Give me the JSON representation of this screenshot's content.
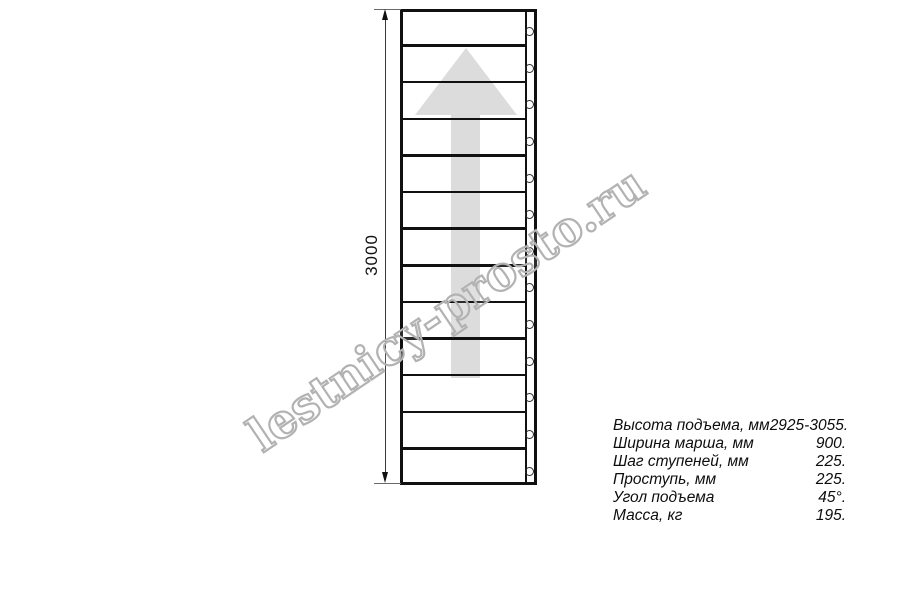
{
  "watermark": {
    "text": "lestnicy-prosto.ru",
    "color": "#b2b2b2"
  },
  "drawing": {
    "dimension_label": "3000",
    "step_rows": 13,
    "hole_count": 13,
    "line_color": "#111111",
    "arrow_color": "#dcdcdc"
  },
  "specs": {
    "rows": [
      {
        "label": "Высота подъема, мм",
        "value": "2925-3055."
      },
      {
        "label": "Ширина марша, мм",
        "value": "900."
      },
      {
        "label": "Шаг ступеней, мм",
        "value": "225."
      },
      {
        "label": "Проступь, мм",
        "value": "225."
      },
      {
        "label": "Угол подъема",
        "value": "45°."
      },
      {
        "label": "Масса, кг",
        "value": "195."
      }
    ]
  }
}
